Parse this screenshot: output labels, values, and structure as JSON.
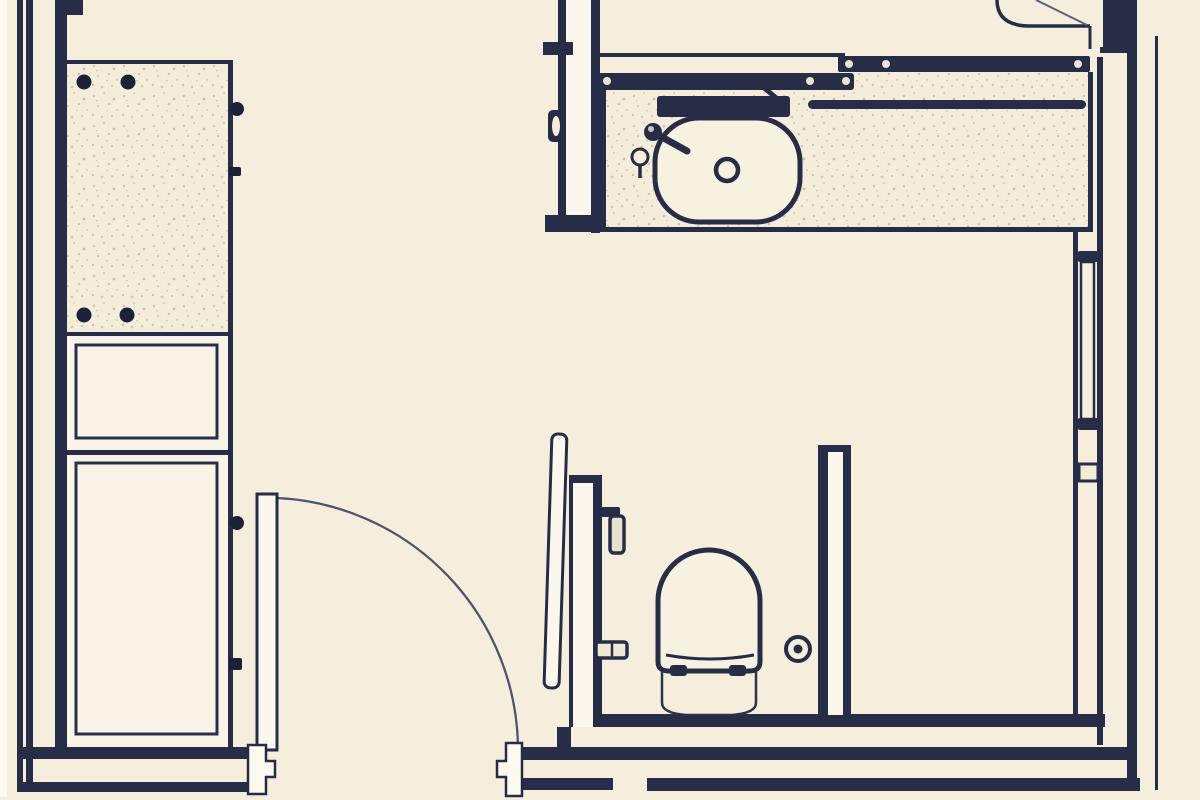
{
  "page": {
    "title": "Bathroom floor plan",
    "type": "architectural-drawing"
  },
  "palette": {
    "background": "#f5eedc",
    "line": "#272d46",
    "line_strong": "#1b2136",
    "panel_white": "#fbf7ec",
    "stipple_base": "#f4eddb",
    "stipple_dot": "#cfc6ae",
    "swing_arc": "#4d5569"
  },
  "plan": {
    "aria_label": "Bathroom floor plan drawing",
    "fixtures": [
      {
        "id": "tall-cabinet",
        "label": "Tall storage cabinet with stippled top, drawer and door fronts"
      },
      {
        "id": "entry-door",
        "label": "Hinged entry door with quarter-circle swing arc"
      },
      {
        "id": "vanity-counter",
        "label": "Stippled vanity counter"
      },
      {
        "id": "sink-basin",
        "label": "Oval basin with drain, mixer tap and pop-up knob"
      },
      {
        "id": "glass-screen",
        "label": "Glass screen bars with fixing clamps"
      },
      {
        "id": "towel-rail",
        "label": "Towel rail on counter"
      },
      {
        "id": "wc-compartment",
        "label": "WC compartment between two partitions"
      },
      {
        "id": "toilet",
        "label": "Wall-hung toilet with seat and bowl projection"
      },
      {
        "id": "floor-drain",
        "label": "Floor drain symbol"
      },
      {
        "id": "shower-door",
        "label": "Curved shower door at top right"
      },
      {
        "id": "door-jambs",
        "label": "Door jamb symbols in bottom wall opening"
      },
      {
        "id": "walls",
        "label": "Exterior and partition walls drawn as navy lines"
      }
    ]
  }
}
